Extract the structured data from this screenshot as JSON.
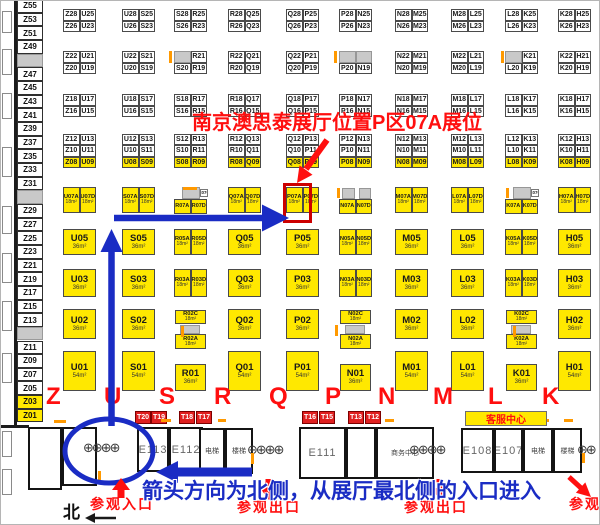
{
  "annotations": {
    "title": "南京澳思泰展厅位置P区07A展位",
    "bottom_blue": "箭头方向为北侧，从展厅最北侧的入口进入",
    "entrance": "参观入口",
    "exit": "参观出口",
    "north": "北",
    "service_center": "客服中心",
    "highlight_booth": "P07A"
  },
  "colors": {
    "booth_yellow": "#ffe800",
    "red": "#ff0f0f",
    "annotation_blue": "#1a2cc4",
    "booth_red": "#e02020",
    "orange": "#ff9900",
    "gray_fill": "#c9c9c9"
  },
  "turnstile_glyph": "⊕",
  "left_column": [
    "Z55",
    "Z53",
    "Z51",
    "Z49",
    "",
    "Z47",
    "Z45",
    "Z43",
    "Z41",
    "Z39",
    "Z37",
    "Z35",
    "Z33",
    "Z31",
    "",
    "Z29",
    "Z27",
    "Z25",
    "Z23",
    "Z21",
    "Z19",
    "Z17",
    "Z15",
    "Z13",
    "",
    "Z11",
    "Z09",
    "Z07",
    "Z05",
    "Z03*",
    "Z01*"
  ],
  "district_letters": [
    {
      "ch": "Z",
      "x": 45
    },
    {
      "ch": "U",
      "x": 103
    },
    {
      "ch": "S",
      "x": 158
    },
    {
      "ch": "R",
      "x": 213
    },
    {
      "ch": "Q",
      "x": 268
    },
    {
      "ch": "P",
      "x": 324
    },
    {
      "ch": "N",
      "x": 377
    },
    {
      "ch": "M",
      "x": 432
    },
    {
      "ch": "L",
      "x": 487
    },
    {
      "ch": "K",
      "x": 541
    }
  ],
  "t_booths": [
    {
      "id": "T20",
      "x": 134
    },
    {
      "id": "T19",
      "x": 150
    },
    {
      "id": "T18",
      "x": 178
    },
    {
      "id": "T17",
      "x": 195
    },
    {
      "id": "T16",
      "x": 301
    },
    {
      "id": "T15",
      "x": 318
    },
    {
      "id": "T13",
      "x": 347
    },
    {
      "id": "T12",
      "x": 364
    }
  ],
  "rooms": [
    {
      "label": "",
      "x": 27,
      "y": 426,
      "w": 34,
      "h": 63,
      "cls": "hall"
    },
    {
      "label": "",
      "x": 61,
      "y": 426,
      "w": 35,
      "h": 59,
      "cls": "hall"
    },
    {
      "label": "E113",
      "x": 136,
      "y": 426,
      "w": 32,
      "h": 45,
      "cls": "hall"
    },
    {
      "label": "E112",
      "x": 168,
      "y": 426,
      "w": 34,
      "h": 45,
      "cls": "hall"
    },
    {
      "label": "电梯",
      "x": 198,
      "y": 427,
      "w": 26,
      "h": 46,
      "cls": "small"
    },
    {
      "label": "楼梯",
      "x": 224,
      "y": 427,
      "w": 28,
      "h": 46,
      "cls": "small"
    },
    {
      "label": "E111",
      "x": 298,
      "y": 426,
      "w": 47,
      "h": 52,
      "cls": "hall"
    },
    {
      "label": "",
      "x": 345,
      "y": 426,
      "w": 30,
      "h": 52,
      "cls": "hall"
    },
    {
      "label": "商务中心",
      "x": 375,
      "y": 426,
      "w": 58,
      "h": 52,
      "cls": "small"
    },
    {
      "label": "E108",
      "x": 460,
      "y": 427,
      "w": 33,
      "h": 45,
      "cls": "hall"
    },
    {
      "label": "E107",
      "x": 493,
      "y": 427,
      "w": 29,
      "h": 45,
      "cls": "hall"
    },
    {
      "label": "电梯",
      "x": 522,
      "y": 427,
      "w": 30,
      "h": 45,
      "cls": "small"
    },
    {
      "label": "楼梯",
      "x": 552,
      "y": 427,
      "w": 29,
      "h": 45,
      "cls": "small"
    }
  ],
  "turnstiles": [
    {
      "x": 82,
      "y": 440,
      "count": 4
    },
    {
      "x": 246,
      "y": 442,
      "count": 4
    },
    {
      "x": 408,
      "y": 442,
      "count": 4
    },
    {
      "x": 576,
      "y": 442,
      "count": 2
    }
  ],
  "orange_marks": [
    {
      "x": 168,
      "y": 50,
      "w": 3,
      "h": 12
    },
    {
      "x": 333,
      "y": 50,
      "w": 3,
      "h": 12
    },
    {
      "x": 500,
      "y": 50,
      "w": 3,
      "h": 12
    },
    {
      "x": 182,
      "y": 186,
      "w": 14,
      "h": 3
    },
    {
      "x": 336,
      "y": 187,
      "w": 3,
      "h": 10
    },
    {
      "x": 505,
      "y": 187,
      "w": 3,
      "h": 10
    },
    {
      "x": 180,
      "y": 325,
      "w": 3,
      "h": 11
    },
    {
      "x": 334,
      "y": 324,
      "w": 3,
      "h": 11
    },
    {
      "x": 512,
      "y": 325,
      "w": 3,
      "h": 11
    },
    {
      "x": 53,
      "y": 419,
      "w": 12,
      "h": 3
    },
    {
      "x": 160,
      "y": 418,
      "w": 10,
      "h": 3
    },
    {
      "x": 217,
      "y": 418,
      "w": 8,
      "h": 3
    },
    {
      "x": 384,
      "y": 418,
      "w": 9,
      "h": 3
    },
    {
      "x": 541,
      "y": 418,
      "w": 7,
      "h": 3
    },
    {
      "x": 563,
      "y": 418,
      "w": 9,
      "h": 3
    },
    {
      "x": 250,
      "y": 452,
      "w": 3,
      "h": 11
    },
    {
      "x": 581,
      "y": 452,
      "w": 3,
      "h": 10
    },
    {
      "x": 97,
      "y": 470,
      "w": 3,
      "h": 10
    }
  ],
  "wall_ticks": [
    {
      "x": 1,
      "y": 10,
      "w": 10,
      "h": 22
    },
    {
      "x": 1,
      "y": 48,
      "w": 10,
      "h": 26
    },
    {
      "x": 1,
      "y": 92,
      "w": 10,
      "h": 26
    },
    {
      "x": 1,
      "y": 146,
      "w": 10,
      "h": 30
    },
    {
      "x": 1,
      "y": 205,
      "w": 10,
      "h": 28
    },
    {
      "x": 1,
      "y": 252,
      "w": 10,
      "h": 30
    },
    {
      "x": 1,
      "y": 300,
      "w": 10,
      "h": 30
    },
    {
      "x": 1,
      "y": 352,
      "w": 10,
      "h": 30
    },
    {
      "x": 1,
      "y": 430,
      "w": 10,
      "h": 26
    },
    {
      "x": 1,
      "y": 468,
      "w": 10,
      "h": 26
    }
  ],
  "walls": [
    {
      "x": 0,
      "y": 424,
      "w": 28,
      "h": 3
    },
    {
      "x": 13,
      "y": 0,
      "w": 3,
      "h": 424
    }
  ],
  "groups": [
    {
      "letter": "Z",
      "b28": [
        "Z28",
        "U25",
        "Z26",
        "U23"
      ],
      "b22": [
        "Z22",
        "U21",
        "Z20",
        "U19"
      ],
      "b18": [
        "Z18",
        "U17",
        "Z16",
        "U15"
      ],
      "b12": [
        "Z12",
        "U13",
        "Z10",
        "U11",
        "Z08",
        "U09"
      ],
      "r07": {
        "kind": "pair",
        "cells": [
          "U07A",
          "U07D"
        ],
        "area": "18m²"
      },
      "r05": {
        "kind": "big",
        "id": "U05",
        "area": "36m²"
      },
      "r03": {
        "kind": "big",
        "id": "U03",
        "area": "36m²"
      },
      "r02": {
        "kind": "big",
        "id": "U02",
        "area": "36m²"
      },
      "r01": {
        "kind": "big",
        "id": "U01",
        "area": "54m²"
      }
    },
    {
      "letter": "U",
      "b28": [
        "U28",
        "S25",
        "U26",
        "S23"
      ],
      "b22": [
        "U22",
        "S21",
        "U20",
        "S19"
      ],
      "b18": [
        "U18",
        "S17",
        "U16",
        "S15"
      ],
      "b12": [
        "U12",
        "S13",
        "U10",
        "S11",
        "U08",
        "S09"
      ],
      "r07": {
        "kind": "pair",
        "cells": [
          "S07A",
          "S07D"
        ],
        "area": "18m²"
      },
      "r05": {
        "kind": "big",
        "id": "S05",
        "area": "36m²"
      },
      "r03": {
        "kind": "big",
        "id": "S03",
        "area": "36m²"
      },
      "r02": {
        "kind": "big",
        "id": "S02",
        "area": "36m²"
      },
      "r01": {
        "kind": "big",
        "id": "S01",
        "area": "54m²"
      }
    },
    {
      "letter": "S",
      "b28": [
        "S28",
        "R25",
        "S26",
        "R23"
      ],
      "b22": [
        "",
        "R21",
        "S20",
        "R19"
      ],
      "b18": [
        "S18",
        "R17",
        "S16",
        "R15"
      ],
      "b12": [
        "S12",
        "R13",
        "S10",
        "R11",
        "S08",
        "R09"
      ],
      "r07": {
        "kind": "pairC",
        "cells": [
          "R07A",
          "R07D"
        ],
        "clabel": "R07C"
      },
      "r05": {
        "kind": "pairA",
        "cells": [
          "R05A",
          "R05D"
        ],
        "area": "18m²"
      },
      "r03": {
        "kind": "pairA",
        "cells": [
          "R03A",
          "R03D"
        ],
        "area": "18m²"
      },
      "r02": {
        "kind": "stack",
        "top": "R02C",
        "bottom": "R02A",
        "area": "18m²"
      },
      "r01": {
        "kind": "big",
        "id": "R01",
        "area": "36m²"
      }
    },
    {
      "letter": "R",
      "b28": [
        "R28",
        "Q25",
        "R26",
        "Q23"
      ],
      "b22": [
        "R22",
        "Q21",
        "R20",
        "Q19"
      ],
      "b18": [
        "R18",
        "Q17",
        "R16",
        "Q15"
      ],
      "b12": [
        "R12",
        "Q13",
        "R10",
        "Q11",
        "R08",
        "Q09"
      ],
      "r07": {
        "kind": "pair",
        "cells": [
          "Q07A",
          "Q07D"
        ],
        "area": "18m²"
      },
      "r05": {
        "kind": "big",
        "id": "Q05",
        "area": "36m²"
      },
      "r03": {
        "kind": "big",
        "id": "Q03",
        "area": "36m²"
      },
      "r02": {
        "kind": "big",
        "id": "Q02",
        "area": "36m²"
      },
      "r01": {
        "kind": "big",
        "id": "Q01",
        "area": "54m²"
      }
    },
    {
      "letter": "Q",
      "b28": [
        "Q28",
        "P25",
        "Q26",
        "P23"
      ],
      "b22": [
        "Q22",
        "P21",
        "Q20",
        "P19"
      ],
      "b18": [
        "Q18",
        "P17",
        "Q16",
        "P15"
      ],
      "b12": [
        "Q12",
        "P13",
        "Q10",
        "P11",
        "Q08",
        "P09"
      ],
      "r07": {
        "kind": "pair",
        "cells": [
          "P07A",
          "P07D"
        ],
        "area": "18m²"
      },
      "r05": {
        "kind": "big",
        "id": "P05",
        "area": "36m²"
      },
      "r03": {
        "kind": "big",
        "id": "P03",
        "area": "36m²"
      },
      "r02": {
        "kind": "big",
        "id": "P02",
        "area": "36m²"
      },
      "r01": {
        "kind": "big",
        "id": "P01",
        "area": "54m²"
      }
    },
    {
      "letter": "P",
      "b28": [
        "P28",
        "N25",
        "P26",
        "N23"
      ],
      "b22": [
        "",
        "",
        "P20",
        "N19"
      ],
      "b18": [
        "P18",
        "N17",
        "P16",
        "N15"
      ],
      "b12": [
        "P12",
        "N13",
        "P10",
        "N11",
        "P08",
        "N09"
      ],
      "r07": {
        "kind": "pairG",
        "cells": [
          "N07A",
          "N07D"
        ]
      },
      "r05": {
        "kind": "pairA",
        "cells": [
          "N05A",
          "N05D"
        ],
        "area": "18m²"
      },
      "r03": {
        "kind": "pairA",
        "cells": [
          "N03A",
          "N03D"
        ],
        "area": "18m²"
      },
      "r02": {
        "kind": "stack",
        "top": "N02C",
        "bottom": "N02A",
        "area": "18m²"
      },
      "r01": {
        "kind": "big",
        "id": "N01",
        "area": "36m²"
      }
    },
    {
      "letter": "N",
      "b28": [
        "N28",
        "M25",
        "N26",
        "M23"
      ],
      "b22": [
        "N22",
        "M21",
        "N20",
        "M19"
      ],
      "b18": [
        "N18",
        "M17",
        "N16",
        "M15"
      ],
      "b12": [
        "N12",
        "M13",
        "N10",
        "M11",
        "N08",
        "M09"
      ],
      "r07": {
        "kind": "pair",
        "cells": [
          "M07A",
          "M07D"
        ],
        "area": "18m²"
      },
      "r05": {
        "kind": "big",
        "id": "M05",
        "area": "36m²"
      },
      "r03": {
        "kind": "big",
        "id": "M03",
        "area": "36m²"
      },
      "r02": {
        "kind": "big",
        "id": "M02",
        "area": "36m²"
      },
      "r01": {
        "kind": "big",
        "id": "M01",
        "area": "54m²"
      }
    },
    {
      "letter": "M",
      "b28": [
        "M28",
        "L25",
        "M26",
        "L23"
      ],
      "b22": [
        "M22",
        "L21",
        "M20",
        "L19"
      ],
      "b18": [
        "M18",
        "L17",
        "M16",
        "L15"
      ],
      "b12": [
        "M12",
        "L13",
        "M10",
        "L11",
        "M08",
        "L09"
      ],
      "r07": {
        "kind": "pair",
        "cells": [
          "L07A",
          "L07D"
        ],
        "area": "18m²"
      },
      "r05": {
        "kind": "big",
        "id": "L05",
        "area": "36m²"
      },
      "r03": {
        "kind": "big",
        "id": "L03",
        "area": "36m²"
      },
      "r02": {
        "kind": "big",
        "id": "L02",
        "area": "36m²"
      },
      "r01": {
        "kind": "big",
        "id": "L01",
        "area": "54m²"
      }
    },
    {
      "letter": "L",
      "b28": [
        "L28",
        "K25",
        "L26",
        "K23"
      ],
      "b22": [
        "",
        "K21",
        "L20",
        "K19"
      ],
      "b18": [
        "L18",
        "K17",
        "L16",
        "K15"
      ],
      "b12": [
        "L12",
        "K13",
        "L10",
        "K11",
        "L08",
        "K09"
      ],
      "r07": {
        "kind": "pairC",
        "cells": [
          "K07A",
          "K07D"
        ],
        "clabel": "K07C"
      },
      "r05": {
        "kind": "pairA",
        "cells": [
          "K05A",
          "K05D"
        ],
        "area": "18m²"
      },
      "r03": {
        "kind": "pairA",
        "cells": [
          "K03A",
          "K03D"
        ],
        "area": "18m²"
      },
      "r02": {
        "kind": "stack",
        "top": "K02C",
        "bottom": "K02A",
        "area": "18m²"
      },
      "r01": {
        "kind": "big",
        "id": "K01",
        "area": "36m²"
      }
    },
    {
      "letter": "K",
      "b28": [
        "K28",
        "H25",
        "K26",
        "H23"
      ],
      "b22": [
        "K22",
        "H21",
        "K20",
        "H19"
      ],
      "b18": [
        "K18",
        "H17",
        "K16",
        "H15"
      ],
      "b12": [
        "K12",
        "H13",
        "K10",
        "H11",
        "K08",
        "H09"
      ],
      "r07": {
        "kind": "pair",
        "cells": [
          "H07A",
          "H07D"
        ],
        "area": "18m²"
      },
      "r05": {
        "kind": "big",
        "id": "H05",
        "area": "36m²"
      },
      "r03": {
        "kind": "big",
        "id": "H03",
        "area": "36m²"
      },
      "r02": {
        "kind": "big",
        "id": "H02",
        "area": "36m²"
      },
      "r01": {
        "kind": "big",
        "id": "H01",
        "area": "54m²"
      }
    }
  ]
}
